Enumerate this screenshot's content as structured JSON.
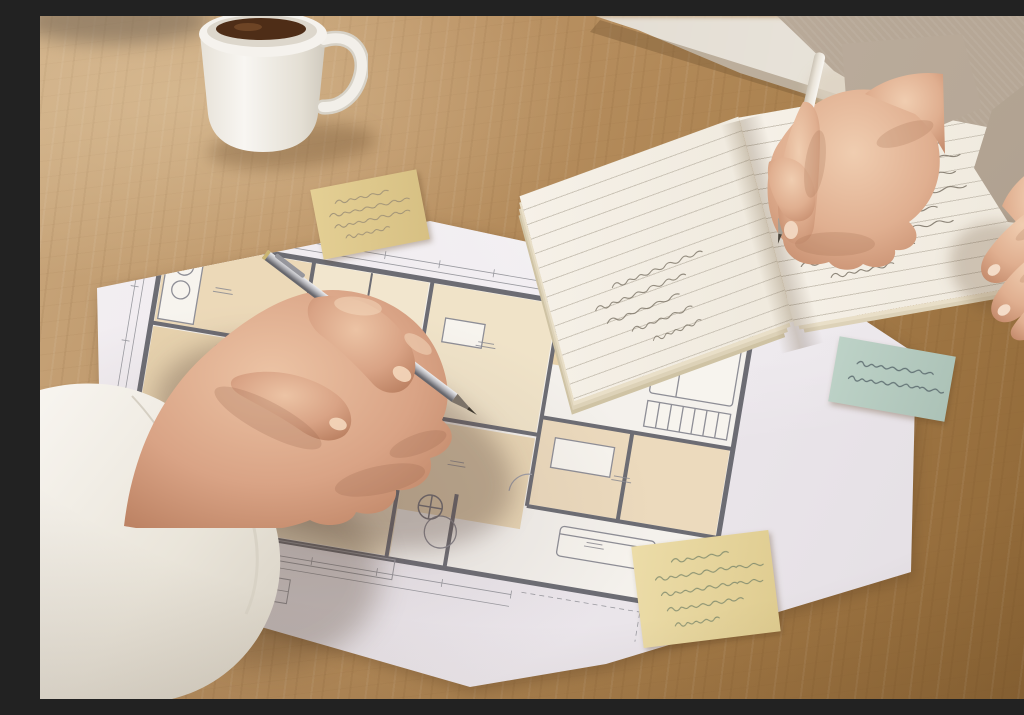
{
  "scene": {
    "type": "photograph",
    "caption": "Two people review a hand-drawn architectural floor plan on a wooden table; the person on the left points at the plan with a silver pen while the person on the right writes in an open ruled notebook with a white pen.",
    "environment": {
      "surface": "wooden table",
      "wood_color": "#ad8452",
      "background_color": "#e2dcd2"
    },
    "coffee_mug": {
      "label": "white ceramic mug with coffee",
      "position": "top left",
      "cup_color": "#f4f1ec",
      "coffee_color": "#4e2d17"
    },
    "floor_plan": {
      "label": "architectural floor plan on white paper",
      "paper_color": "#efeaee",
      "wall_color": "#6c6c73",
      "room_fill_colors": [
        "#ecd9b8",
        "#f2e6ce",
        "#e8d3ae",
        "#f0e3c8",
        "#ecdabd",
        "#eedfc2"
      ],
      "features": [
        "room outlines",
        "furniture symbols",
        "compass circles",
        "door arcs",
        "dimension lines",
        "schedule table",
        "tiny illegible room labels"
      ]
    },
    "sticky_notes": [
      {
        "id": "top-left",
        "color": "#ddc88d",
        "ink_color": "#8f8472",
        "handwriting_lines": 4,
        "handwriting": "illegible"
      },
      {
        "id": "right",
        "color": "#b7cdc2",
        "ink_color": "#5b6a6e",
        "handwriting_lines": 2,
        "handwriting": "illegible"
      },
      {
        "id": "bottom",
        "color": "#e7d7a2",
        "ink_color": "#7f8a6d",
        "handwriting_lines": 5,
        "handwriting": "illegible"
      }
    ],
    "notebook": {
      "label": "open ruled notebook with handwritten notes",
      "page_color": "#f3eee4",
      "rule_color": "#ccc5b8",
      "ink_color": "#7b7366",
      "handwriting": "illegible"
    },
    "pens": [
      {
        "id": "silver-pen",
        "color": "#a9a9ad",
        "held_by": "person-left",
        "pointing_at": "floor plan"
      },
      {
        "id": "white-pen",
        "color": "#f2eee8",
        "held_by": "person-right",
        "writing_in": "notebook"
      }
    ],
    "people": [
      {
        "id": "person-left",
        "visible": "hand and white shirt sleeve",
        "sleeve_color": "#f2efe9",
        "skin_tone": "#d9a687"
      },
      {
        "id": "person-right",
        "visible": "both hands and beige sweater",
        "sweater_color": "#c0b2a2",
        "skin_tone": "#e5bb9e"
      }
    ]
  }
}
